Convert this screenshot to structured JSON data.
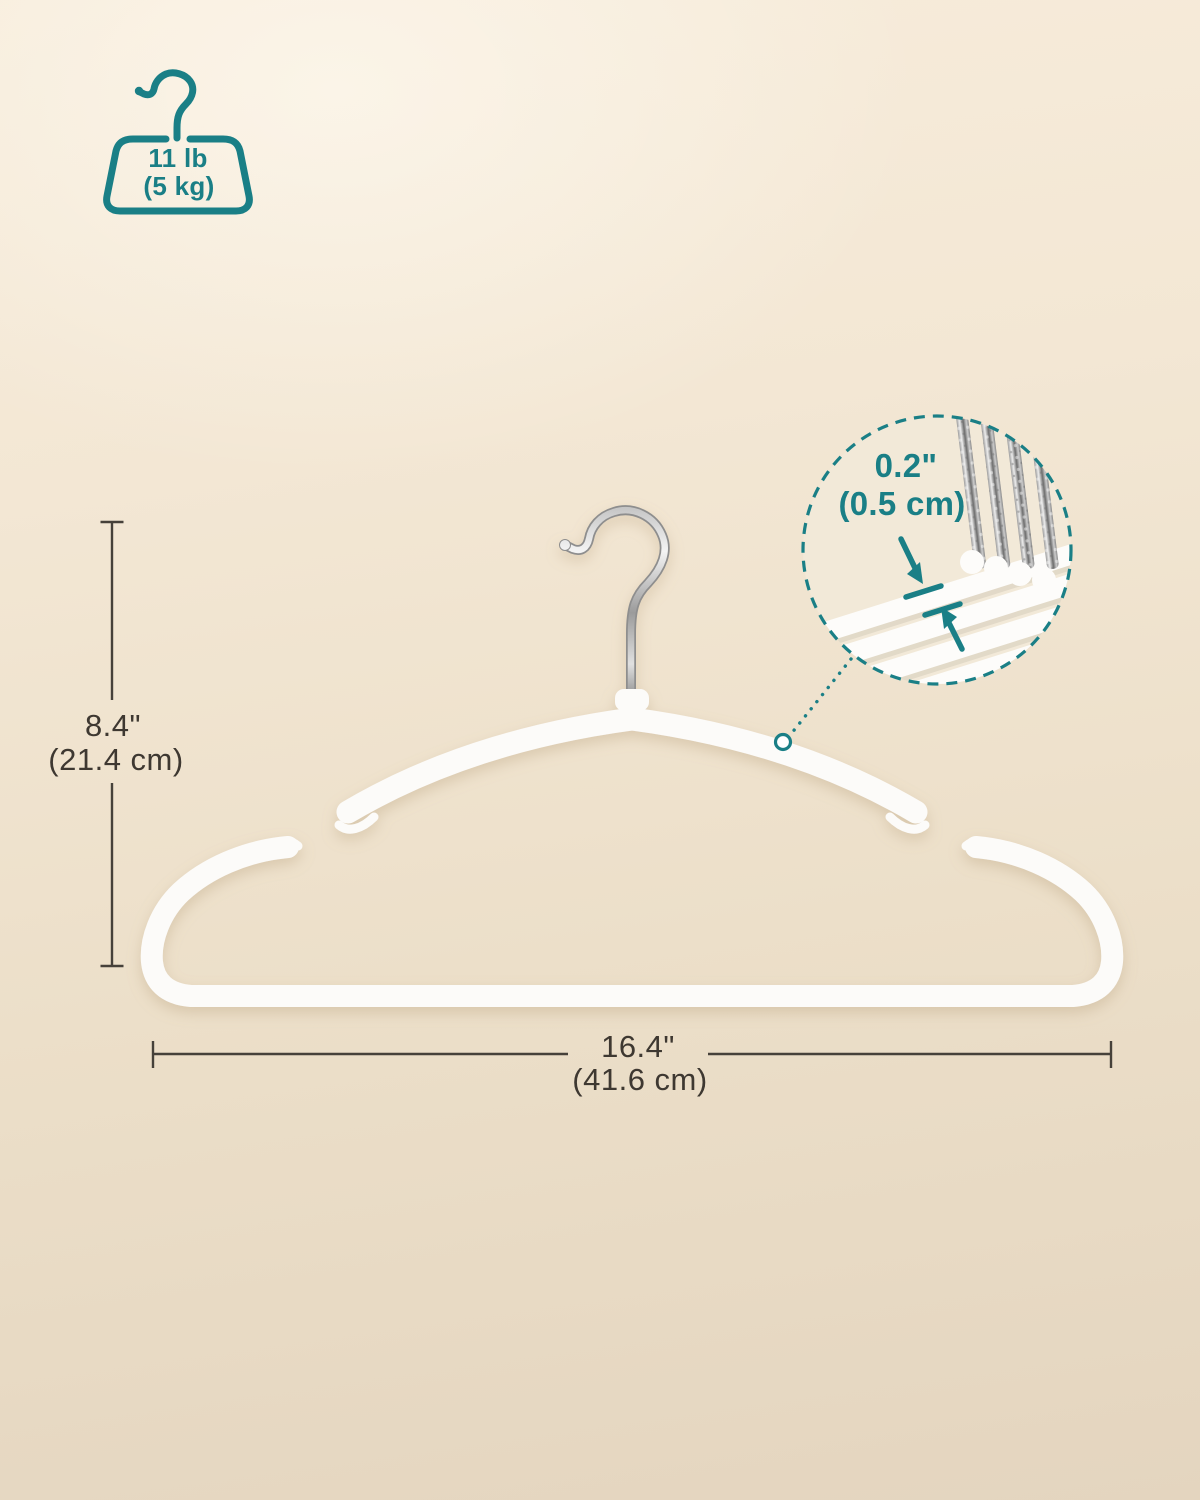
{
  "product_diagram": {
    "description_labels": {
      "weight_capacity": {
        "imperial": "11 lb",
        "metric": "(5 kg)"
      },
      "hanger_height": {
        "imperial": "8.4\"",
        "metric": "(21.4 cm)"
      },
      "hanger_width": {
        "imperial": "16.4\"",
        "metric": "(41.6 cm)"
      },
      "hanger_thickness": {
        "imperial": "0.2\"",
        "metric": "(0.5 cm)"
      }
    },
    "icons": [
      "weight-capacity-hanger-icon",
      "swivel-hook-icon",
      "magnifier-detail-circle",
      "leader-dotted-line",
      "thickness-arrows"
    ],
    "colors": {
      "accent_teal": "#1a7f86",
      "dimension_text": "#3e3831",
      "dimension_line": "#46413a",
      "hanger_white": "#fcfbf9",
      "background_top": "#f7ecdb",
      "background_bottom": "#e4d5bf",
      "chrome_light": "#f2f2f2",
      "chrome_dark": "#8f8f8f"
    }
  }
}
